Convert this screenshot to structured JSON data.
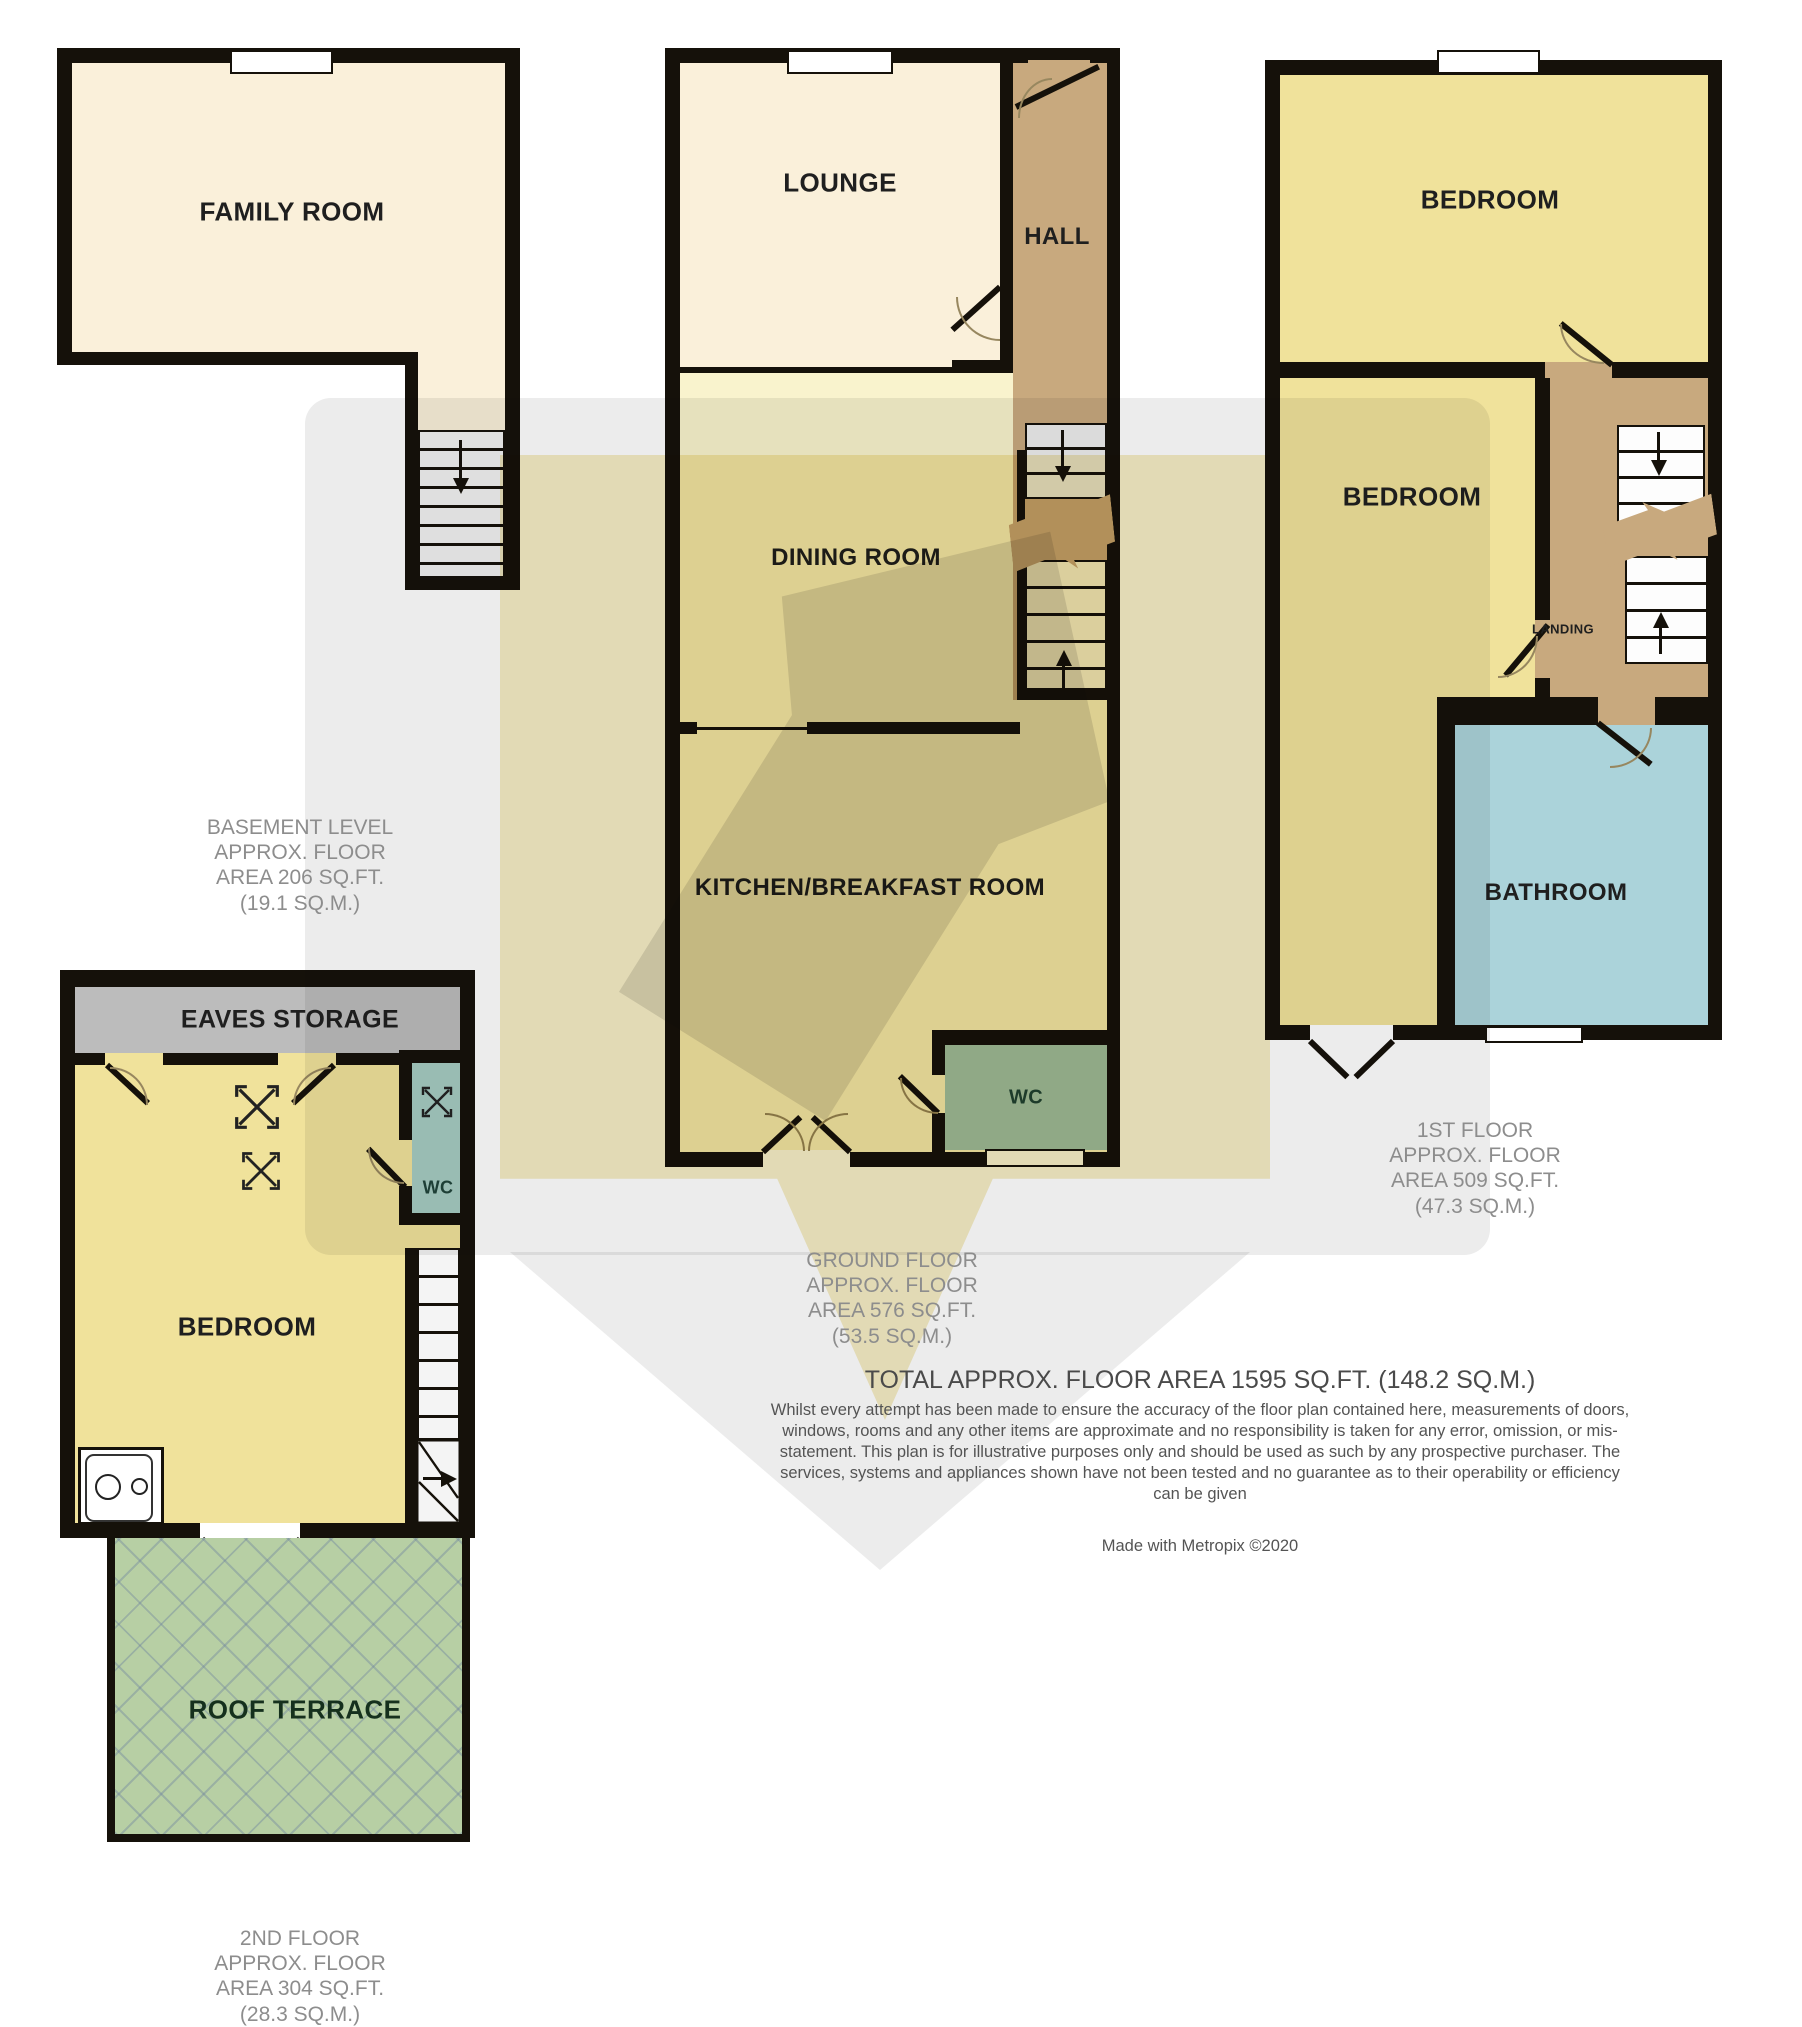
{
  "document": {
    "type": "estate-agent floor plan",
    "credit": "Made with Metropix ©2020"
  },
  "palette": {
    "wall": "#15110a",
    "cream_room": "#faf0da",
    "pale_yellow_room": "#f9f3cd",
    "bedroom_yellow": "#f0e29b",
    "hall_tan": "#c8a97e",
    "wc_teal": "#a2c6bd",
    "bathroom_blue": "#abd3da",
    "eaves_gray": "#bcbcbc",
    "terrace_green": "#b7cfa4",
    "watermark_gray": "#ececec",
    "watermark_yellow": "#f5ecc4",
    "area_text_gray": "#8d8d8d"
  },
  "floors": {
    "basement": {
      "area_label": "BASEMENT LEVEL\nAPPROX. FLOOR\nAREA 206 SQ.FT.\n(19.1 SQ.M.)",
      "rooms": {
        "family_room": "FAMILY ROOM"
      }
    },
    "ground": {
      "area_label": "GROUND FLOOR\nAPPROX. FLOOR\nAREA 576 SQ.FT.\n(53.5 SQ.M.)",
      "rooms": {
        "lounge": "LOUNGE",
        "hall": "HALL",
        "dining_room": "DINING ROOM",
        "kitchen": "KITCHEN/BREAKFAST ROOM",
        "wc": "WC"
      }
    },
    "first": {
      "area_label": "1ST FLOOR\nAPPROX. FLOOR\nAREA 509 SQ.FT.\n(47.3 SQ.M.)",
      "rooms": {
        "bedroom_front": "BEDROOM",
        "bedroom_back": "BEDROOM",
        "landing": "LANDING",
        "bathroom": "BATHROOM"
      }
    },
    "second": {
      "area_label": "2ND FLOOR\nAPPROX. FLOOR\nAREA 304 SQ.FT.\n(28.3 SQ.M.)",
      "rooms": {
        "eaves_storage": "EAVES STORAGE",
        "wc": "WC",
        "bedroom": "BEDROOM",
        "roof_terrace": "ROOF TERRACE"
      }
    }
  },
  "summary": {
    "total_area": "TOTAL APPROX. FLOOR AREA 1595 SQ.FT. (148.2 SQ.M.)",
    "disclaimer": "Whilst every attempt has been made to ensure the accuracy of the floor plan contained here, measurements of doors, windows, rooms and any other items are approximate and no responsibility is taken for any error, omission, or mis-statement. This plan is for illustrative purposes only and should be used as such by any prospective purchaser. The services, systems and appliances shown have not been tested and no guarantee as to their operability or efficiency can be given",
    "credit": "Made with Metropix ©2020"
  }
}
